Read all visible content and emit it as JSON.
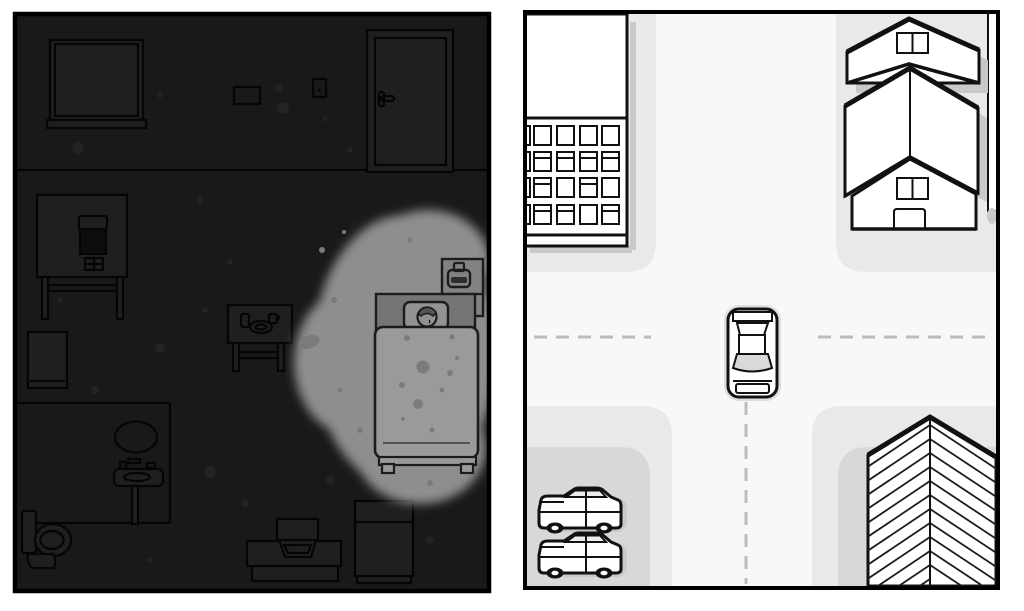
{
  "scene": {
    "description": "Split-screen hand-drawn game scene: dark top-down bedroom at night (left) and a bright top-down street T-intersection (right)",
    "panels": [
      {
        "id": "bedroom-night",
        "side": "left",
        "lighting": "dark with one gray spotlight over the bed",
        "objects": [
          "window with sill",
          "picture frame",
          "light switch",
          "door with handle",
          "desk with computer monitor and keyboard",
          "bathroom door",
          "bathroom walls",
          "oval mirror",
          "pedestal sink",
          "toilet",
          "side table with glass, ashtray dish and cup",
          "bed with sleeping person on pillow",
          "blanket with fold line",
          "nightstand with bedside lamp",
          "tv stand with television",
          "cabinet"
        ]
      },
      {
        "id": "street-intersection",
        "side": "right",
        "lighting": "daylight, white road with gray sidewalks",
        "objects": [
          "apartment building with 4x4 window grid",
          "gabled house small",
          "gabled house large with window and door",
          "fence strip",
          "chevron-shingle roof building",
          "driving car on road",
          "two parked cars in parking bay",
          "dashed road center lines"
        ]
      }
    ]
  },
  "colors": {
    "page_bg": "#ffffff",
    "panel_border": "#000000",
    "room_bg": "#191919",
    "room_fill": "#1f1f1f",
    "room_line": "#050505",
    "room_screen": "#0d0d0d",
    "room_speckle": "#232323",
    "spot_fill": "#8e8e8e",
    "spot_speckle": "#7b7b7b",
    "bed_blanket": "#9a9a9a",
    "bed_pillow": "#929292",
    "bed_headboard": "#757575",
    "bed_line": "#1c1c1c",
    "nightstand_fill": "#828282",
    "lamp_slot": "#2e2e2e",
    "street_bg": "#f8f8f8",
    "sidewalk": "#e9e9e9",
    "yard": "#d8d8d8",
    "building_fill": "#ffffff",
    "ink": "#111111",
    "shadow": "#c9c9c9",
    "dash": "#bcbcbc",
    "windshield": "#d9d9d9",
    "car_halo": "#dedede"
  }
}
